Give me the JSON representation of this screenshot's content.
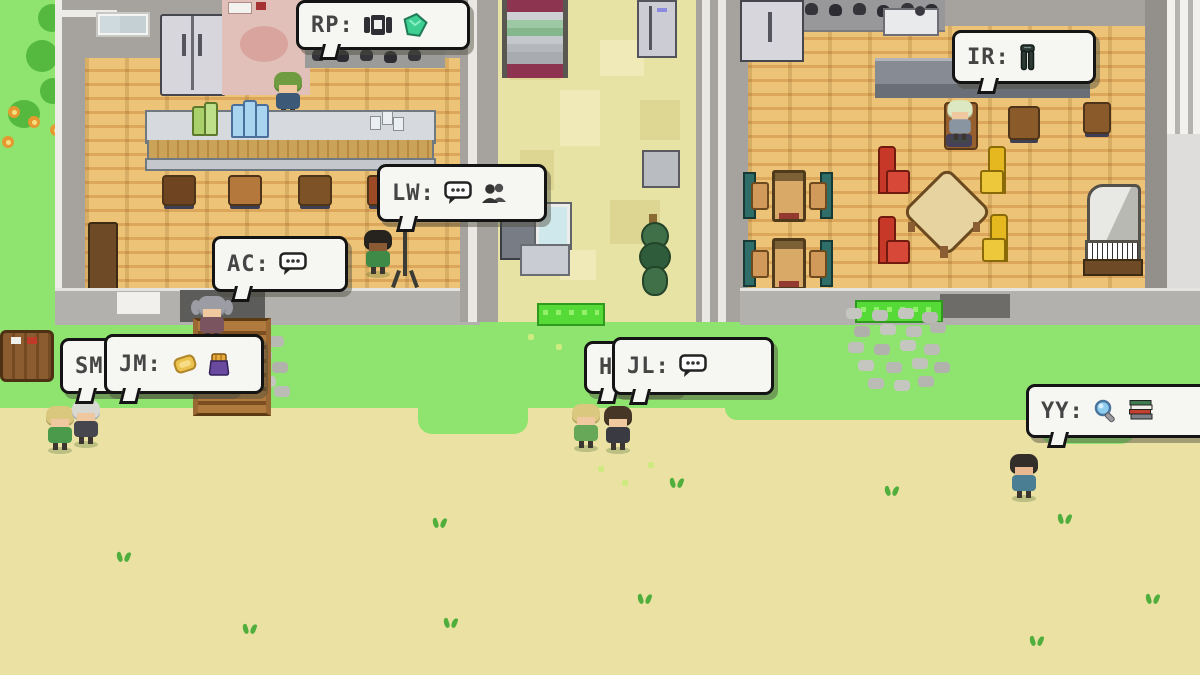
{
  "scene": {
    "type": "pixel-art life-simulation game map with speaking agents",
    "palette": {
      "grass": "#8ee46e",
      "sand": "#eae1a3",
      "building_wall": "#a6a39e",
      "wood_floor": "#e9c074",
      "hall_floor": "#e7e3a4",
      "bubble_bg": "#f6f6f3",
      "bubble_border": "#141414",
      "doormat_green": "#56da38"
    }
  },
  "speech_bubbles": [
    {
      "id": "rp",
      "label": "RP:",
      "icons": [
        "press-machine-icon",
        "gem-icon"
      ]
    },
    {
      "id": "ir",
      "label": "IR:",
      "icons": [
        "trousers-icon"
      ]
    },
    {
      "id": "lw",
      "label": "LW:",
      "icons": [
        "chat-dots-icon",
        "people-icon"
      ]
    },
    {
      "id": "ac",
      "label": "AC:",
      "icons": [
        "chat-dots-icon"
      ]
    },
    {
      "id": "sm",
      "label": "SM:",
      "icons": []
    },
    {
      "id": "jm",
      "label": "JM:",
      "icons": [
        "toast-icon",
        "bag-icon"
      ]
    },
    {
      "id": "hi",
      "label": "HI",
      "icons": []
    },
    {
      "id": "jl",
      "label": "JL:",
      "icons": [
        "chat-dots-icon"
      ]
    },
    {
      "id": "yy",
      "label": "YY:",
      "icons": [
        "magnifier-icon",
        "books-icon"
      ]
    }
  ]
}
